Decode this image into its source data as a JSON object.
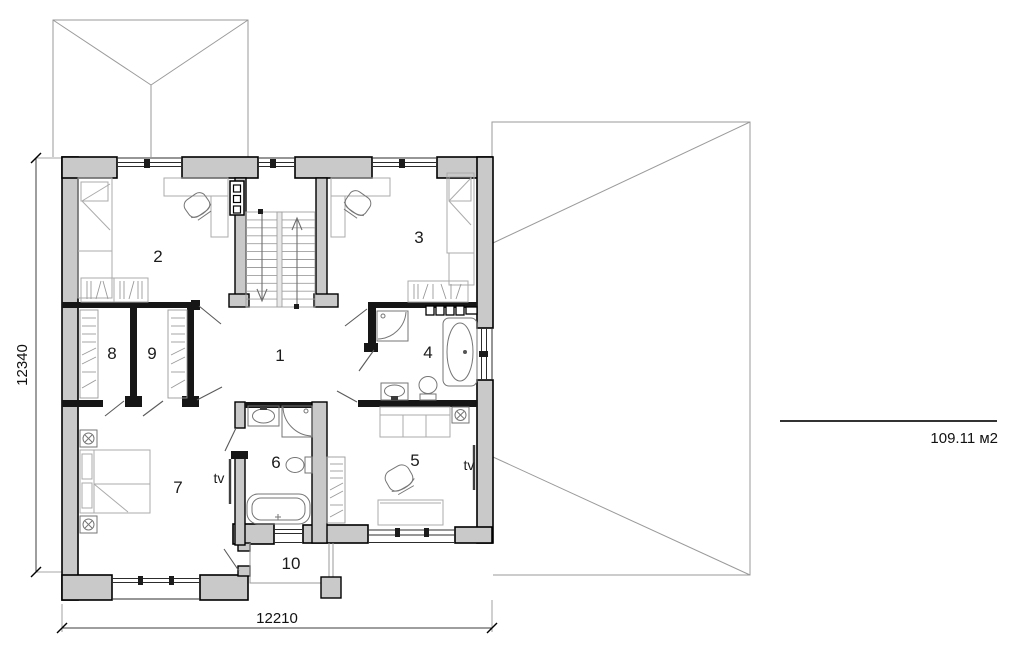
{
  "plan": {
    "rooms": [
      {
        "label": "1"
      },
      {
        "label": "2"
      },
      {
        "label": "3"
      },
      {
        "label": "4"
      },
      {
        "label": "5"
      },
      {
        "label": "6"
      },
      {
        "label": "7"
      },
      {
        "label": "8"
      },
      {
        "label": "9"
      },
      {
        "label": "10"
      }
    ],
    "tv_label": "tv",
    "dimensions": {
      "vertical": "12340",
      "horizontal": "12210"
    },
    "area_label": "109.11 м2",
    "colors": {
      "wall_fill": "#c9c9c9",
      "wall_outline": "#000000",
      "thin_line": "#9a9a9a",
      "dimension_line": "#3c3c3c"
    }
  }
}
